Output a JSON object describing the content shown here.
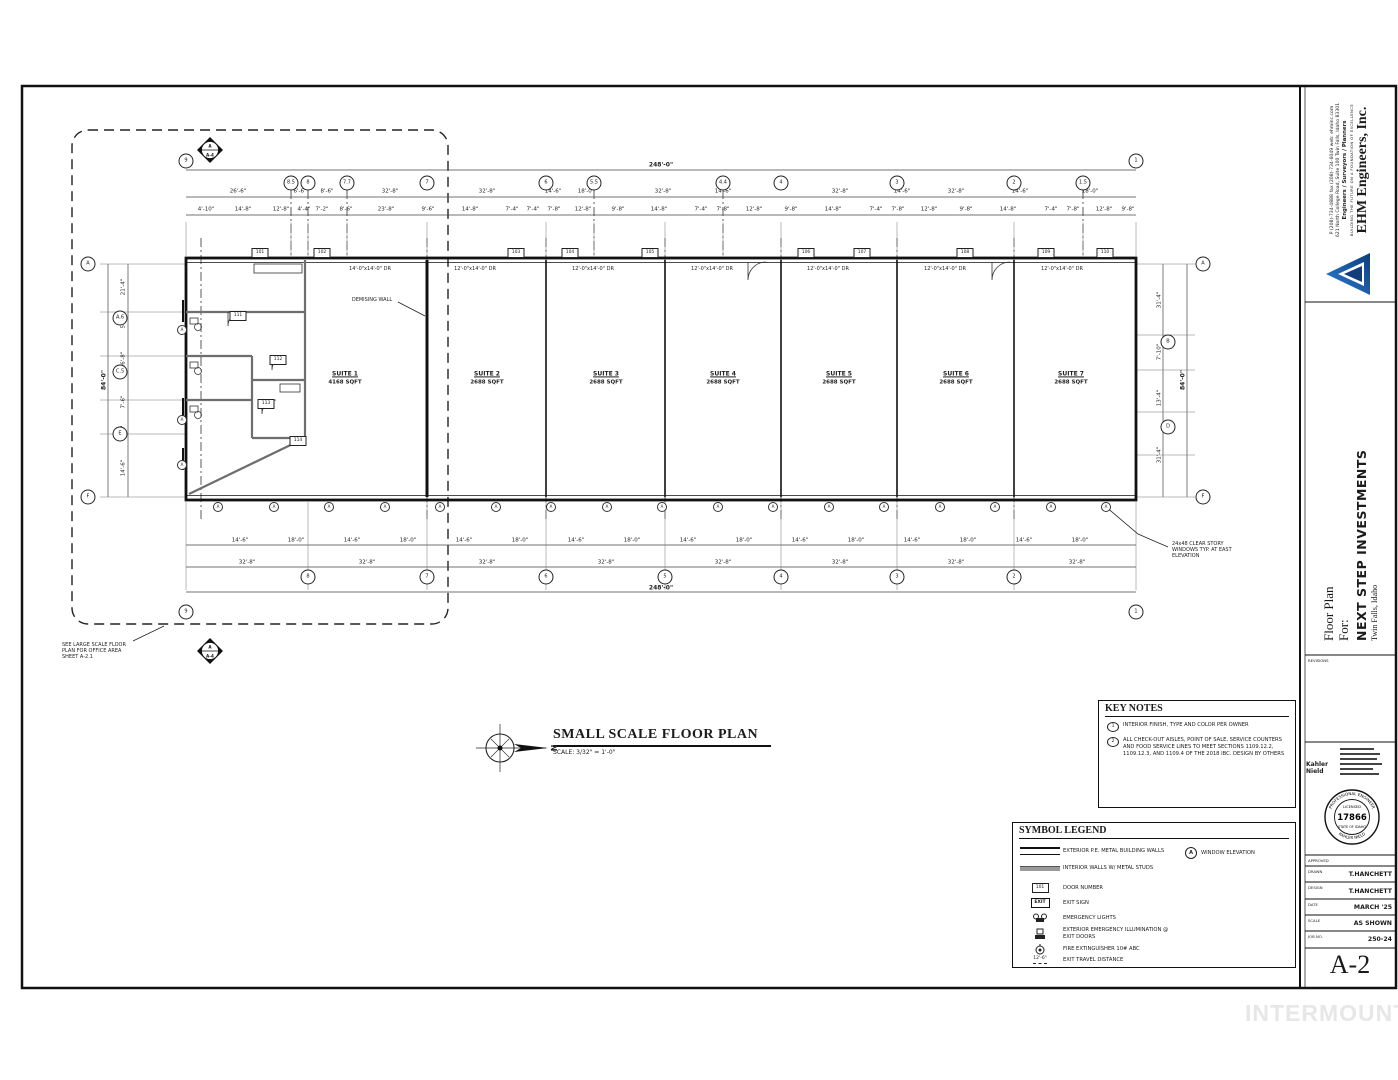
{
  "sheet": {
    "number": "A-2",
    "watermark": "INTERMOUNTAIN"
  },
  "firm": {
    "name": "EHM Engineers, Inc.",
    "tagline": "BUILDING THE FUTURE ON A FOUNDATION OF EXCELLENCE",
    "services": "Engineers / Surveyors / Planners",
    "address": "621 North College Road, Suite 100  Twin Falls, Idaho  83301",
    "contact": "P (208)-734-4888  fax (208)-734-6049  web: ehminc.com"
  },
  "project": {
    "title_line1": "Floor Plan",
    "title_line2": "For:",
    "name": "NEXT STEP INVESTMENTS",
    "location": "Twin Falls, Idaho"
  },
  "titleblock": {
    "revisions_label": "REVISIONS",
    "approved_label": "APPROVED",
    "engineer_name": "Kahler Nield",
    "stamp": {
      "ring_top": "PROFESSIONAL ENGINEER",
      "licensed": "LICENSED",
      "number": "17866",
      "state": "STATE OF IDAHO",
      "ring_bottom": "KAHLER NIELD"
    },
    "fields": [
      {
        "label": "DRAWN",
        "value": "T.HANCHETT"
      },
      {
        "label": "DESIGN",
        "value": "T.HANCHETT"
      },
      {
        "label": "DATE",
        "value": "MARCH '25"
      },
      {
        "label": "SCALE",
        "value": "AS SHOWN"
      },
      {
        "label": "JOB NO.",
        "value": "250-24"
      }
    ],
    "sheet_number": "A-2"
  },
  "drawing_title": {
    "title": "SMALL SCALE FLOOR PLAN",
    "scale": "SCALE: 3/32\" = 1'-0\""
  },
  "key_notes": {
    "title": "KEY NOTES",
    "notes": [
      {
        "num": "1",
        "text": "INTERIOR FINISH, TYPE AND COLOR PER OWNER"
      },
      {
        "num": "2",
        "text": "ALL CHECK-OUT AISLES, POINT OF SALE, SERVICE COUNTERS AND FOOD SERVICE LINES TO MEET SECTIONS 1109.12.2, 1109.12.3, AND 1109.4 OF THE 2018 IBC.  DESIGN BY OTHERS"
      }
    ]
  },
  "symbol_legend": {
    "title": "SYMBOL LEGEND",
    "door_sample": "101",
    "exit_sample": "EXIT",
    "travel_sample": "12'-6\"",
    "window_elevation_symbol": "A",
    "items": [
      {
        "label": "EXTERIOR P.E. METAL BUILDING WALLS"
      },
      {
        "label": "INTERIOR WALLS W/ METAL STUDS"
      },
      {
        "label": "DOOR NUMBER"
      },
      {
        "label": "EXIT SIGN"
      },
      {
        "label": "EMERGENCY LIGHTS"
      },
      {
        "label": "EXTERIOR EMERGENCY ILLUMINATION @ EXIT DOORS"
      },
      {
        "label": "FIRE EXTINGUISHER 10# ABC"
      },
      {
        "label": "EXIT TRAVEL DISTANCE"
      }
    ],
    "window_elevation_label": "WINDOW ELEVATION"
  },
  "plan": {
    "texts": [
      {
        "t": "248'-0\"",
        "x": 661,
        "y": 165,
        "c": "ov"
      },
      {
        "t": "26'-6\"",
        "x": 238,
        "y": 192,
        "c": "d"
      },
      {
        "t": "6'-6\"",
        "x": 300,
        "y": 192,
        "c": "d"
      },
      {
        "t": "8'-6\"",
        "x": 327,
        "y": 192,
        "c": "d"
      },
      {
        "t": "32'-8\"",
        "x": 390,
        "y": 192,
        "c": "d"
      },
      {
        "t": "32'-8\"",
        "x": 487,
        "y": 192,
        "c": "d"
      },
      {
        "t": "14'-6\"",
        "x": 553,
        "y": 192,
        "c": "d"
      },
      {
        "t": "18'-0\"",
        "x": 586,
        "y": 192,
        "c": "d"
      },
      {
        "t": "32'-8\"",
        "x": 663,
        "y": 192,
        "c": "d"
      },
      {
        "t": "14'-6\"",
        "x": 723,
        "y": 192,
        "c": "d"
      },
      {
        "t": "32'-8\"",
        "x": 840,
        "y": 192,
        "c": "d"
      },
      {
        "t": "14'-6\"",
        "x": 902,
        "y": 192,
        "c": "d"
      },
      {
        "t": "32'-8\"",
        "x": 956,
        "y": 192,
        "c": "d"
      },
      {
        "t": "14'-6\"",
        "x": 1020,
        "y": 192,
        "c": "d"
      },
      {
        "t": "18'-0\"",
        "x": 1090,
        "y": 192,
        "c": "d"
      },
      {
        "t": "4'-10\"",
        "x": 206,
        "y": 210,
        "c": "d"
      },
      {
        "t": "14'-8\"",
        "x": 243,
        "y": 210,
        "c": "d"
      },
      {
        "t": "12'-8\"",
        "x": 281,
        "y": 210,
        "c": "d"
      },
      {
        "t": "4'-4\"",
        "x": 304,
        "y": 210,
        "c": "d"
      },
      {
        "t": "7'-2\"",
        "x": 322,
        "y": 210,
        "c": "d"
      },
      {
        "t": "8'-6\"",
        "x": 346,
        "y": 210,
        "c": "d"
      },
      {
        "t": "23'-8\"",
        "x": 386,
        "y": 210,
        "c": "d"
      },
      {
        "t": "9'-6\"",
        "x": 428,
        "y": 210,
        "c": "d"
      },
      {
        "t": "14'-8\"",
        "x": 470,
        "y": 210,
        "c": "d"
      },
      {
        "t": "7'-4\"",
        "x": 512,
        "y": 210,
        "c": "d"
      },
      {
        "t": "7'-4\"",
        "x": 533,
        "y": 210,
        "c": "d"
      },
      {
        "t": "7'-8\"",
        "x": 554,
        "y": 210,
        "c": "d"
      },
      {
        "t": "12'-8\"",
        "x": 583,
        "y": 210,
        "c": "d"
      },
      {
        "t": "9'-8\"",
        "x": 618,
        "y": 210,
        "c": "d"
      },
      {
        "t": "14'-8\"",
        "x": 659,
        "y": 210,
        "c": "d"
      },
      {
        "t": "7'-4\"",
        "x": 701,
        "y": 210,
        "c": "d"
      },
      {
        "t": "7'-8\"",
        "x": 723,
        "y": 210,
        "c": "d"
      },
      {
        "t": "12'-8\"",
        "x": 754,
        "y": 210,
        "c": "d"
      },
      {
        "t": "9'-8\"",
        "x": 791,
        "y": 210,
        "c": "d"
      },
      {
        "t": "14'-8\"",
        "x": 833,
        "y": 210,
        "c": "d"
      },
      {
        "t": "7'-4\"",
        "x": 876,
        "y": 210,
        "c": "d"
      },
      {
        "t": "7'-8\"",
        "x": 898,
        "y": 210,
        "c": "d"
      },
      {
        "t": "12'-8\"",
        "x": 929,
        "y": 210,
        "c": "d"
      },
      {
        "t": "9'-8\"",
        "x": 966,
        "y": 210,
        "c": "d"
      },
      {
        "t": "14'-8\"",
        "x": 1008,
        "y": 210,
        "c": "d"
      },
      {
        "t": "7'-4\"",
        "x": 1051,
        "y": 210,
        "c": "d"
      },
      {
        "t": "7'-8\"",
        "x": 1073,
        "y": 210,
        "c": "d"
      },
      {
        "t": "12'-8\"",
        "x": 1104,
        "y": 210,
        "c": "d"
      },
      {
        "t": "9'-8\"",
        "x": 1128,
        "y": 210,
        "c": "d"
      },
      {
        "t": "14'-6\"",
        "x": 240,
        "y": 541,
        "c": "d"
      },
      {
        "t": "18'-0\"",
        "x": 296,
        "y": 541,
        "c": "d"
      },
      {
        "t": "14'-6\"",
        "x": 352,
        "y": 541,
        "c": "d"
      },
      {
        "t": "18'-0\"",
        "x": 408,
        "y": 541,
        "c": "d"
      },
      {
        "t": "14'-6\"",
        "x": 464,
        "y": 541,
        "c": "d"
      },
      {
        "t": "18'-0\"",
        "x": 520,
        "y": 541,
        "c": "d"
      },
      {
        "t": "14'-6\"",
        "x": 576,
        "y": 541,
        "c": "d"
      },
      {
        "t": "18'-0\"",
        "x": 632,
        "y": 541,
        "c": "d"
      },
      {
        "t": "14'-6\"",
        "x": 688,
        "y": 541,
        "c": "d"
      },
      {
        "t": "18'-0\"",
        "x": 744,
        "y": 541,
        "c": "d"
      },
      {
        "t": "14'-6\"",
        "x": 800,
        "y": 541,
        "c": "d"
      },
      {
        "t": "18'-0\"",
        "x": 856,
        "y": 541,
        "c": "d"
      },
      {
        "t": "14'-6\"",
        "x": 912,
        "y": 541,
        "c": "d"
      },
      {
        "t": "18'-0\"",
        "x": 968,
        "y": 541,
        "c": "d"
      },
      {
        "t": "14'-6\"",
        "x": 1024,
        "y": 541,
        "c": "d"
      },
      {
        "t": "18'-0\"",
        "x": 1080,
        "y": 541,
        "c": "d"
      },
      {
        "t": "32'-8\"",
        "x": 247,
        "y": 563,
        "c": "d"
      },
      {
        "t": "32'-8\"",
        "x": 367,
        "y": 563,
        "c": "d"
      },
      {
        "t": "32'-8\"",
        "x": 487,
        "y": 563,
        "c": "d"
      },
      {
        "t": "32'-8\"",
        "x": 606,
        "y": 563,
        "c": "d"
      },
      {
        "t": "32'-8\"",
        "x": 723,
        "y": 563,
        "c": "d"
      },
      {
        "t": "32'-8\"",
        "x": 840,
        "y": 563,
        "c": "d"
      },
      {
        "t": "32'-8\"",
        "x": 956,
        "y": 563,
        "c": "d"
      },
      {
        "t": "32'-8\"",
        "x": 1077,
        "y": 563,
        "c": "d"
      },
      {
        "t": "248'-0\"",
        "x": 661,
        "y": 588,
        "c": "ov"
      },
      {
        "t": "84'-0\"",
        "x": 104,
        "y": 380,
        "c": "ov",
        "r": -90
      },
      {
        "t": "21'-4\"",
        "x": 124,
        "y": 287,
        "c": "d",
        "r": -90
      },
      {
        "t": "5'-5\"",
        "x": 124,
        "y": 322,
        "c": "d",
        "r": -90
      },
      {
        "t": "16'-8\"",
        "x": 124,
        "y": 360,
        "c": "d",
        "r": -90
      },
      {
        "t": "7'-6\"",
        "x": 124,
        "y": 402,
        "c": "d",
        "r": -90
      },
      {
        "t": "7'-4\"",
        "x": 124,
        "y": 432,
        "c": "d",
        "r": -90
      },
      {
        "t": "14'-6\"",
        "x": 124,
        "y": 468,
        "c": "d",
        "r": -90
      },
      {
        "t": "31'-4\"",
        "x": 1160,
        "y": 300,
        "c": "d",
        "r": -90
      },
      {
        "t": "7'-10\"",
        "x": 1160,
        "y": 352,
        "c": "d",
        "r": -90
      },
      {
        "t": "13'-4\"",
        "x": 1160,
        "y": 398,
        "c": "d",
        "r": -90
      },
      {
        "t": "31'-4\"",
        "x": 1160,
        "y": 455,
        "c": "d",
        "r": -90
      },
      {
        "t": "84'-0\"",
        "x": 1183,
        "y": 380,
        "c": "ov",
        "r": -90
      },
      {
        "t": "14'-0\"x14'-0\" DR",
        "x": 370,
        "y": 269,
        "c": "dl"
      },
      {
        "t": "12'-0\"x14'-0\" DR",
        "x": 475,
        "y": 269,
        "c": "dl"
      },
      {
        "t": "12'-0\"x14'-0\" DR",
        "x": 593,
        "y": 269,
        "c": "dl"
      },
      {
        "t": "12'-0\"x14'-0\" DR",
        "x": 712,
        "y": 269,
        "c": "dl"
      },
      {
        "t": "12'-0\"x14'-0\" DR",
        "x": 828,
        "y": 269,
        "c": "dl"
      },
      {
        "t": "12'-0\"x14'-0\" DR",
        "x": 945,
        "y": 269,
        "c": "dl"
      },
      {
        "t": "12'-0\"x14'-0\" DR",
        "x": 1062,
        "y": 269,
        "c": "dl"
      },
      {
        "t": "SUITE 1",
        "x": 345,
        "y": 374,
        "c": "sut"
      },
      {
        "t": "4168 SQFT",
        "x": 345,
        "y": 383,
        "c": "ar"
      },
      {
        "t": "SUITE 2",
        "x": 487,
        "y": 374,
        "c": "sut"
      },
      {
        "t": "2688 SQFT",
        "x": 487,
        "y": 383,
        "c": "ar"
      },
      {
        "t": "SUITE 3",
        "x": 606,
        "y": 374,
        "c": "sut"
      },
      {
        "t": "2688 SQFT",
        "x": 606,
        "y": 383,
        "c": "ar"
      },
      {
        "t": "SUITE 4",
        "x": 723,
        "y": 374,
        "c": "sut"
      },
      {
        "t": "2688 SQFT",
        "x": 723,
        "y": 383,
        "c": "ar"
      },
      {
        "t": "SUITE 5",
        "x": 839,
        "y": 374,
        "c": "sut"
      },
      {
        "t": "2688 SQFT",
        "x": 839,
        "y": 383,
        "c": "ar"
      },
      {
        "t": "SUITE 6",
        "x": 956,
        "y": 374,
        "c": "sut"
      },
      {
        "t": "2688 SQFT",
        "x": 956,
        "y": 383,
        "c": "ar"
      },
      {
        "t": "SUITE 7",
        "x": 1071,
        "y": 374,
        "c": "sut"
      },
      {
        "t": "2688 SQFT",
        "x": 1071,
        "y": 383,
        "c": "ar"
      },
      {
        "t": "DEMISING WALL",
        "x": 372,
        "y": 300,
        "c": "dl"
      },
      {
        "t": "24x48  CLEAR STORY\nWINDOWS TYP. AT EAST\nELEVATION",
        "x": 1172,
        "y": 550,
        "c": "note"
      },
      {
        "t": "SEE LARGE SCALE FLOOR\nPLAN FOR OFFICE AREA\nSHEET A-2.1",
        "x": 62,
        "y": 651,
        "c": "note"
      },
      {
        "t": "N",
        "x": 553,
        "y": 748,
        "c": "cmp",
        "r": 90
      },
      {
        "t": "A",
        "x": 210,
        "y": 146,
        "c": "sec"
      },
      {
        "t": "A-4",
        "x": 210,
        "y": 155,
        "c": "sec"
      },
      {
        "t": "A",
        "x": 210,
        "y": 647,
        "c": "sec"
      },
      {
        "t": "A-4",
        "x": 210,
        "y": 656,
        "c": "sec"
      }
    ],
    "bubbles": [
      {
        "t": "9",
        "x": 186,
        "y": 161
      },
      {
        "t": "8.5",
        "x": 291,
        "y": 183
      },
      {
        "t": "8",
        "x": 308,
        "y": 183
      },
      {
        "t": "7.7",
        "x": 347,
        "y": 183
      },
      {
        "t": "7",
        "x": 427,
        "y": 183
      },
      {
        "t": "6",
        "x": 546,
        "y": 183
      },
      {
        "t": "5.5",
        "x": 594,
        "y": 183
      },
      {
        "t": "4.4",
        "x": 723,
        "y": 183
      },
      {
        "t": "4",
        "x": 781,
        "y": 183
      },
      {
        "t": "3",
        "x": 897,
        "y": 183
      },
      {
        "t": "2",
        "x": 1014,
        "y": 183
      },
      {
        "t": "1.5",
        "x": 1083,
        "y": 183
      },
      {
        "t": "1",
        "x": 1136,
        "y": 161
      },
      {
        "t": "9",
        "x": 186,
        "y": 612
      },
      {
        "t": "8",
        "x": 308,
        "y": 577
      },
      {
        "t": "7",
        "x": 427,
        "y": 577
      },
      {
        "t": "6",
        "x": 546,
        "y": 577
      },
      {
        "t": "5",
        "x": 665,
        "y": 577
      },
      {
        "t": "4",
        "x": 781,
        "y": 577
      },
      {
        "t": "3",
        "x": 897,
        "y": 577
      },
      {
        "t": "2",
        "x": 1014,
        "y": 577
      },
      {
        "t": "1",
        "x": 1136,
        "y": 612
      },
      {
        "t": "A",
        "x": 88,
        "y": 264
      },
      {
        "t": "A.6",
        "x": 120,
        "y": 318
      },
      {
        "t": "C.5",
        "x": 120,
        "y": 372
      },
      {
        "t": "E",
        "x": 120,
        "y": 434
      },
      {
        "t": "F",
        "x": 88,
        "y": 497
      },
      {
        "t": "A",
        "x": 1203,
        "y": 264
      },
      {
        "t": "B",
        "x": 1168,
        "y": 342
      },
      {
        "t": "D",
        "x": 1168,
        "y": 427
      },
      {
        "t": "F",
        "x": 1203,
        "y": 497
      }
    ],
    "door_tags": [
      {
        "t": "101",
        "x": 260,
        "y": 253
      },
      {
        "t": "102",
        "x": 322,
        "y": 253
      },
      {
        "t": "103",
        "x": 516,
        "y": 253
      },
      {
        "t": "104",
        "x": 570,
        "y": 253
      },
      {
        "t": "105",
        "x": 650,
        "y": 253
      },
      {
        "t": "106",
        "x": 806,
        "y": 253
      },
      {
        "t": "107",
        "x": 862,
        "y": 253
      },
      {
        "t": "108",
        "x": 965,
        "y": 253
      },
      {
        "t": "109",
        "x": 1046,
        "y": 253
      },
      {
        "t": "110",
        "x": 1105,
        "y": 253
      },
      {
        "t": "111",
        "x": 238,
        "y": 316
      },
      {
        "t": "112",
        "x": 278,
        "y": 360
      },
      {
        "t": "113",
        "x": 266,
        "y": 404
      },
      {
        "t": "114",
        "x": 298,
        "y": 441
      }
    ],
    "window_tags": [
      {
        "t": "A",
        "x": 218,
        "y": 507
      },
      {
        "t": "A",
        "x": 274,
        "y": 507
      },
      {
        "t": "A",
        "x": 329,
        "y": 507
      },
      {
        "t": "A",
        "x": 385,
        "y": 507
      },
      {
        "t": "A",
        "x": 440,
        "y": 507
      },
      {
        "t": "A",
        "x": 496,
        "y": 507
      },
      {
        "t": "A",
        "x": 551,
        "y": 507
      },
      {
        "t": "A",
        "x": 607,
        "y": 507
      },
      {
        "t": "A",
        "x": 662,
        "y": 507
      },
      {
        "t": "A",
        "x": 718,
        "y": 507
      },
      {
        "t": "A",
        "x": 773,
        "y": 507
      },
      {
        "t": "A",
        "x": 829,
        "y": 507
      },
      {
        "t": "A",
        "x": 884,
        "y": 507
      },
      {
        "t": "A",
        "x": 940,
        "y": 507
      },
      {
        "t": "A",
        "x": 995,
        "y": 507
      },
      {
        "t": "A",
        "x": 1051,
        "y": 507
      },
      {
        "t": "A",
        "x": 1106,
        "y": 507
      },
      {
        "t": "A",
        "x": 182,
        "y": 330
      },
      {
        "t": "A",
        "x": 182,
        "y": 420
      },
      {
        "t": "A",
        "x": 182,
        "y": 465
      }
    ]
  }
}
